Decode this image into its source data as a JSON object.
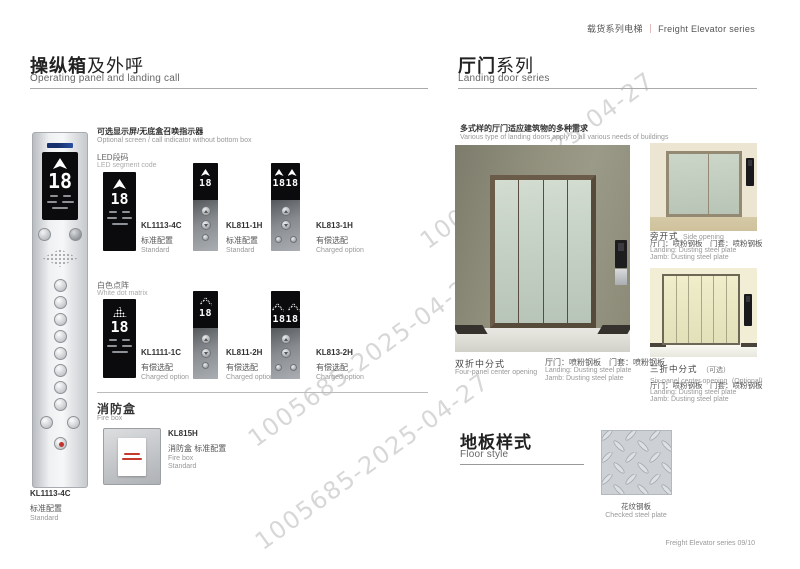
{
  "page": {
    "header": {
      "series_zh": "载货系列电梯",
      "sep": "｜",
      "series_en": "Freight Elevator series"
    },
    "footer": {
      "text": "Freight Elevator series  09/10"
    },
    "watermark": {
      "text": "1005685-2025-04-27"
    }
  },
  "panel_section": {
    "title_zh_b": "操纵箱",
    "title_zh_r": "及外呼",
    "title_en": "Operating panel and landing call",
    "optional_zh": "可选显示屏/无底盒召唤指示器",
    "optional_en": "Optional screen / call indicator without bottom box",
    "cop": {
      "model": "KL1113-4C",
      "config_zh": "标准配置",
      "config_en": "Standard",
      "floor": "18"
    },
    "groups": [
      {
        "name_zh": "LED段码",
        "name_en": "LED segment code",
        "items": [
          {
            "model": "KL1113-4C",
            "config_zh": "标准配置",
            "config_en": "Standard",
            "floor": "18"
          },
          {
            "model": "KL811-1H",
            "config_zh": "标准配置",
            "config_en": "Standard",
            "floor": "18"
          },
          {
            "model": "KL813-1H",
            "config_zh": "有偿选配",
            "config_en": "Charged option",
            "floor": "1818"
          }
        ]
      },
      {
        "name_zh": "白色点阵",
        "name_en": "White dot matrix",
        "items": [
          {
            "model": "KL1111-1C",
            "config_zh": "有偿选配",
            "config_en": "Charged option",
            "floor": "18"
          },
          {
            "model": "KL811-2H",
            "config_zh": "有偿选配",
            "config_en": "Charged option",
            "floor": "18"
          },
          {
            "model": "KL813-2H",
            "config_zh": "有偿选配",
            "config_en": "Charged option",
            "floor": "1818"
          }
        ]
      }
    ],
    "firebox": {
      "title_zh": "消防盒",
      "title_en": "Fire box",
      "model": "KL815H",
      "desc_zh": "消防盒 标准配置",
      "desc_en1": "Fire box",
      "desc_en2": "Standard"
    }
  },
  "door_section": {
    "title_zh_b": "厅门",
    "title_zh_r": "系列",
    "title_en": "Landing  door series",
    "intro_zh": "多式样的厅门适应建筑物的多种需求",
    "intro_en": "Various type of landing doors apply to all various needs of buildings",
    "doors": [
      {
        "name_zh": "双折中分式",
        "name_en": "Four-panel center opening",
        "spec_zh": "厅门：喷粉钢板　门套：喷粉钢板",
        "spec_en1": "Landing: Dusting steel plate",
        "spec_en2": "Jamb: Dusting steel plate"
      },
      {
        "name_zh": "旁开式",
        "name_en": "Side opening",
        "spec_zh": "厅门：喷粉钢板　门套：喷粉钢板",
        "spec_en1": "Landing: Dusting steel plate",
        "spec_en2": "Jamb: Dusting steel plate"
      },
      {
        "name_zh": "三折中分式",
        "note_zh": "（可选）",
        "name_en": "Six-panel center opening",
        "note_en": "(Optional)",
        "spec_zh": "厅门：喷粉钢板　门套：喷粉钢板",
        "spec_en1": "Landing: Dusting steel plate",
        "spec_en2": "Jamb: Dusting steel plate"
      }
    ]
  },
  "floor_section": {
    "title_zh": "地板样式",
    "title_en": "Floor style",
    "caption_zh": "花纹钢板",
    "caption_en": "Checked steel plate"
  }
}
